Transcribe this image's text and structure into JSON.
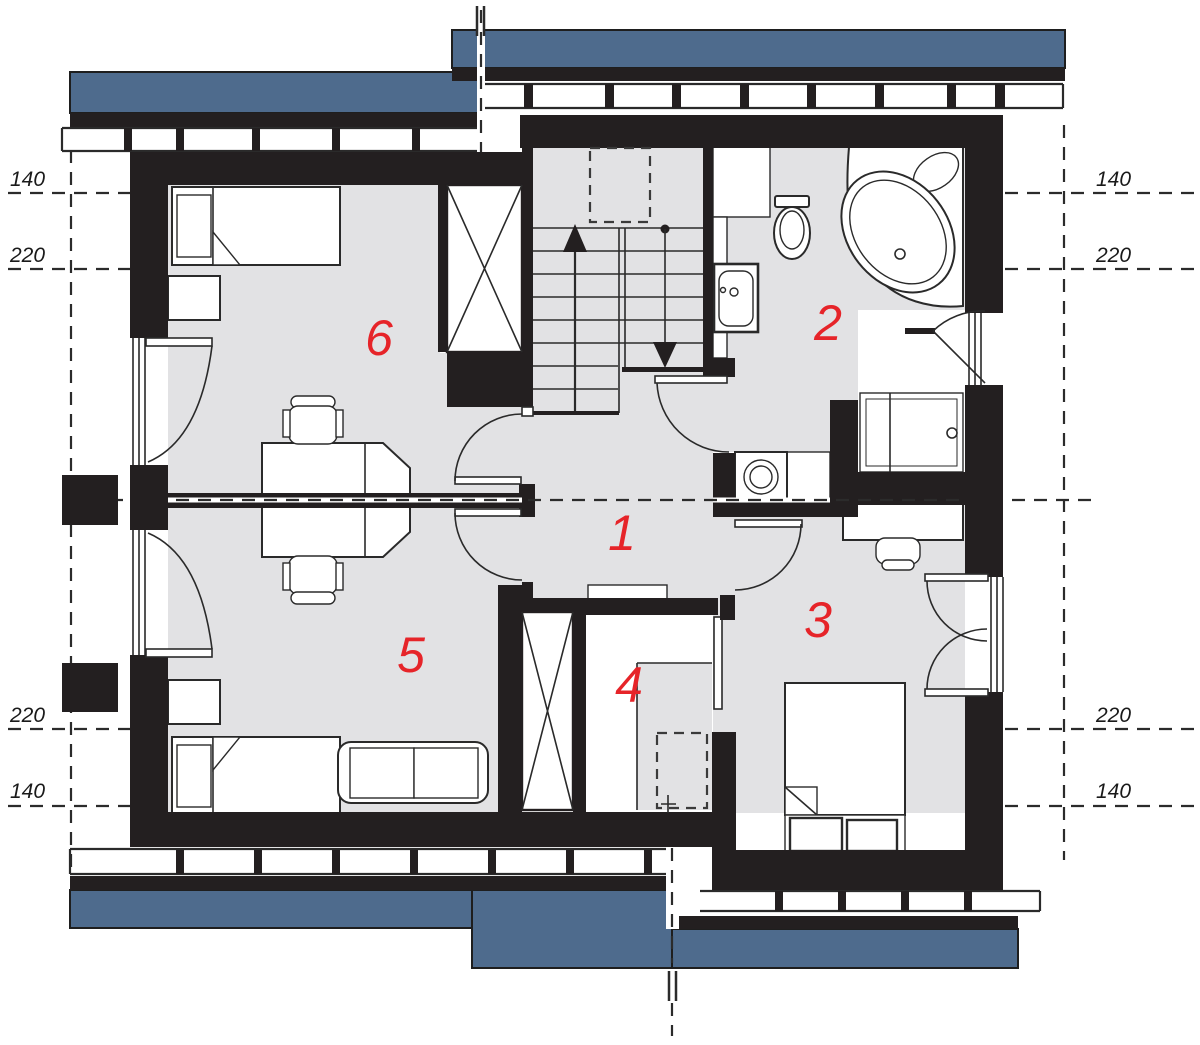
{
  "drawing": {
    "type": "architectural-floor-plan",
    "floor": "attic storey"
  },
  "colors": {
    "roof_blue": "#4e6b8d",
    "wall_black": "#231f20",
    "floor_gray": "#e2e2e4",
    "label_red": "#e62429"
  },
  "room_labels": [
    {
      "number": "1"
    },
    {
      "number": "2"
    },
    {
      "number": "3"
    },
    {
      "number": "4"
    },
    {
      "number": "5"
    },
    {
      "number": "6"
    }
  ],
  "dimension_labels": {
    "left": [
      "140",
      "220",
      "220",
      "140"
    ],
    "right": [
      "140",
      "220",
      "220",
      "140"
    ]
  }
}
